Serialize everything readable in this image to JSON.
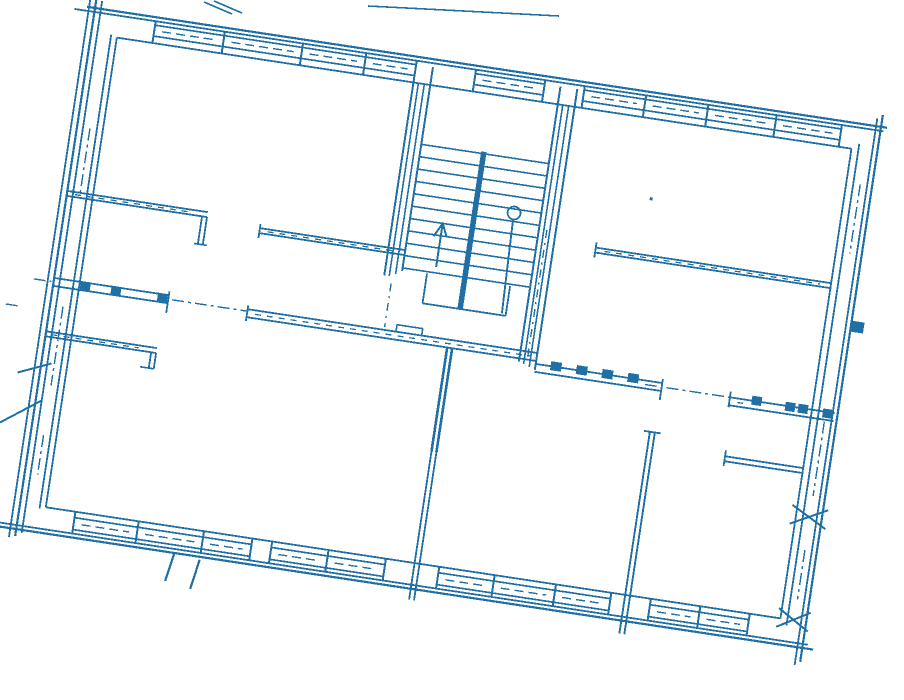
{
  "colors": {
    "ink": "#2070a6",
    "paper": "#ffffff"
  },
  "canvas": {
    "width": 904,
    "height": 700
  },
  "layout": {
    "origin_x": 95,
    "origin_y": 8,
    "rotation_deg": 8.6,
    "plan_width": 795,
    "plan_height": 527
  },
  "plan_layers": [
    {
      "name": "exterior-walls",
      "lines": [
        [
          -8,
          0,
          801,
          0,
          2.2
        ],
        [
          -20,
          4,
          798,
          4,
          1.8
        ],
        [
          26,
          26,
          769,
          26,
          1.8
        ],
        [
          26,
          501,
          769,
          501,
          1.8
        ],
        [
          -28,
          523,
          800,
          523,
          1.8
        ],
        [
          -20,
          527,
          806,
          527,
          2.2
        ],
        [
          -6,
          -10,
          -6,
          536,
          1.8
        ],
        [
          0,
          -14,
          0,
          534,
          2.2
        ],
        [
          6,
          -8,
          6,
          530,
          1.8
        ],
        [
          20,
          24,
          20,
          503,
          1.8
        ],
        [
          26,
          26,
          26,
          501,
          1.8
        ],
        [
          769,
          26,
          769,
          501,
          1.8
        ],
        [
          776,
          20,
          776,
          507,
          1.8
        ],
        [
          790,
          -8,
          790,
          545,
          1.8
        ],
        [
          795,
          -12,
          795,
          541,
          2.2
        ]
      ]
    },
    {
      "name": "ribbon-windows",
      "lines": [
        [
          62,
          8,
          326,
          8,
          1.7
        ],
        [
          62,
          19,
          326,
          19,
          1.7
        ],
        [
          386,
          8,
          456,
          8,
          1.7
        ],
        [
          386,
          19,
          456,
          19,
          1.7
        ],
        [
          496,
          8,
          756,
          8,
          1.7
        ],
        [
          496,
          19,
          756,
          19,
          1.7
        ],
        [
          62,
          4,
          62,
          26,
          2
        ],
        [
          132,
          4,
          132,
          26,
          2
        ],
        [
          211,
          4,
          211,
          26,
          2
        ],
        [
          275,
          4,
          275,
          26,
          2
        ],
        [
          326,
          4,
          326,
          26,
          2
        ],
        [
          386,
          4,
          386,
          26,
          2
        ],
        [
          456,
          4,
          456,
          26,
          2
        ],
        [
          496,
          4,
          496,
          26,
          2
        ],
        [
          558,
          4,
          558,
          26,
          2
        ],
        [
          621,
          4,
          621,
          26,
          2
        ],
        [
          690,
          4,
          690,
          26,
          2
        ],
        [
          756,
          4,
          756,
          26,
          2
        ],
        [
          56,
          507,
          235,
          507,
          1.7
        ],
        [
          56,
          519,
          235,
          519,
          1.7
        ],
        [
          255,
          507,
          370,
          507,
          1.7
        ],
        [
          255,
          519,
          370,
          519,
          1.7
        ],
        [
          424,
          507,
          598,
          507,
          1.7
        ],
        [
          424,
          519,
          598,
          519,
          1.7
        ],
        [
          638,
          507,
          738,
          507,
          1.7
        ],
        [
          638,
          519,
          738,
          519,
          1.7
        ],
        [
          56,
          501,
          56,
          523,
          2
        ],
        [
          120,
          501,
          120,
          523,
          2
        ],
        [
          186,
          501,
          186,
          523,
          2
        ],
        [
          235,
          501,
          235,
          523,
          2
        ],
        [
          255,
          501,
          255,
          523,
          2
        ],
        [
          312,
          501,
          312,
          523,
          2
        ],
        [
          370,
          501,
          370,
          523,
          2
        ],
        [
          424,
          501,
          424,
          523,
          2
        ],
        [
          480,
          501,
          480,
          523,
          2
        ],
        [
          542,
          501,
          542,
          523,
          2
        ],
        [
          598,
          501,
          598,
          523,
          2
        ],
        [
          638,
          501,
          638,
          523,
          2
        ],
        [
          688,
          501,
          688,
          523,
          2
        ],
        [
          738,
          501,
          738,
          523,
          2
        ]
      ],
      "dash": "9 5",
      "dashed": [
        [
          70,
          13.5,
          124,
          13.5,
          1.4
        ],
        [
          140,
          13.5,
          203,
          13.5,
          1.4
        ],
        [
          219,
          13.5,
          267,
          13.5,
          1.4
        ],
        [
          283,
          13.5,
          318,
          13.5,
          1.4
        ],
        [
          394,
          13.5,
          448,
          13.5,
          1.4
        ],
        [
          504,
          13.5,
          550,
          13.5,
          1.4
        ],
        [
          566,
          13.5,
          613,
          13.5,
          1.4
        ],
        [
          629,
          13.5,
          682,
          13.5,
          1.4
        ],
        [
          698,
          13.5,
          748,
          13.5,
          1.4
        ],
        [
          64,
          513,
          112,
          513,
          1.4
        ],
        [
          128,
          513,
          178,
          513,
          1.4
        ],
        [
          194,
          513,
          227,
          513,
          1.4
        ],
        [
          263,
          513,
          304,
          513,
          1.4
        ],
        [
          320,
          513,
          362,
          513,
          1.4
        ],
        [
          432,
          513,
          472,
          513,
          1.4
        ],
        [
          488,
          513,
          534,
          513,
          1.4
        ],
        [
          550,
          513,
          590,
          513,
          1.4
        ],
        [
          646,
          513,
          680,
          513,
          1.4
        ],
        [
          696,
          513,
          730,
          513,
          1.4
        ]
      ]
    },
    {
      "name": "interior-walls",
      "lines": [
        [
          0,
          185,
          142,
          185,
          1.8
        ],
        [
          0,
          190,
          142,
          190,
          1.8
        ],
        [
          137,
          190,
          137,
          218,
          1.8
        ],
        [
          142,
          190,
          142,
          218,
          1.8
        ],
        [
          133,
          218,
          146,
          218,
          1.6
        ],
        [
          196,
          193,
          344,
          193,
          1.8
        ],
        [
          196,
          198,
          344,
          198,
          1.8
        ],
        [
          196,
          189,
          196,
          203,
          1.8
        ],
        [
          531,
          162,
          770,
          162,
          1.8
        ],
        [
          531,
          167,
          770,
          167,
          1.8
        ],
        [
          531,
          157,
          531,
          172,
          1.8
        ],
        [
          0,
          327,
          112,
          327,
          1.8
        ],
        [
          0,
          332,
          112,
          332,
          1.8
        ],
        [
          107,
          332,
          107,
          348,
          1.8
        ],
        [
          112,
          332,
          112,
          348,
          1.8
        ],
        [
          98,
          348,
          112,
          348,
          1.6
        ],
        [
          0,
          273,
          116,
          273,
          1.8
        ],
        [
          0,
          281,
          116,
          281,
          1.8
        ],
        [
          116,
          269,
          116,
          291,
          1.8
        ],
        [
          196,
          275,
          489,
          275,
          1.8
        ],
        [
          196,
          283,
          489,
          283,
          1.8
        ],
        [
          196,
          271,
          196,
          287,
          1.8
        ],
        [
          346,
          268,
          372,
          268,
          1.6
        ],
        [
          346,
          268,
          346,
          275,
          1.6
        ],
        [
          372,
          268,
          372,
          275,
          1.6
        ],
        [
          489,
          286,
          617,
          286,
          1.8
        ],
        [
          489,
          294,
          617,
          294,
          1.8
        ],
        [
          617,
          282,
          617,
          303,
          1.8
        ],
        [
          686,
          290,
          792,
          290,
          1.8
        ],
        [
          686,
          298,
          792,
          298,
          1.8
        ],
        [
          686,
          284,
          686,
          300,
          1.8
        ],
        [
          399,
          283,
          399,
          388,
          2.6
        ],
        [
          404,
          283,
          404,
          388,
          2.6
        ],
        [
          399,
          388,
          399,
          538,
          1.8
        ],
        [
          404,
          388,
          404,
          538,
          1.8
        ],
        [
          612,
          336,
          612,
          540,
          1.9
        ],
        [
          617,
          336,
          617,
          540,
          1.9
        ],
        [
          606,
          336,
          623,
          336,
          1.8
        ],
        [
          690,
          349,
          770,
          349,
          1.8
        ],
        [
          690,
          354,
          770,
          354,
          1.8
        ],
        [
          690,
          343,
          690,
          359,
          1.8
        ],
        [
          160,
          527,
          155,
          556,
          2.2
        ],
        [
          186,
          530,
          181,
          560,
          2.2
        ]
      ],
      "dash": "6 6",
      "dashed": [
        [
          8,
          187.5,
          128,
          187.5,
          1.3
        ],
        [
          204,
          195.5,
          336,
          195.5,
          1.3
        ],
        [
          540,
          164.5,
          758,
          164.5,
          1.3
        ],
        [
          6,
          329.5,
          94,
          329.5,
          1.3
        ],
        [
          204,
          279,
          482,
          279,
          1.3
        ],
        [
          694,
          294,
          706,
          294,
          1.3
        ]
      ]
    },
    {
      "name": "staircase",
      "lines": [
        [
          326,
          8,
          326,
          221,
          2
        ],
        [
          331,
          26,
          331,
          221,
          1.6
        ],
        [
          337,
          26,
          337,
          218,
          1.6
        ],
        [
          343,
          8,
          343,
          214,
          2
        ],
        [
          472,
          8,
          472,
          286,
          2
        ],
        [
          477,
          26,
          477,
          288,
          1.6
        ],
        [
          483,
          26,
          483,
          290,
          1.6
        ],
        [
          489,
          8,
          489,
          292,
          2
        ],
        [
          343,
          86,
          472,
          86,
          1.6
        ],
        [
          343,
          98.5,
          472,
          98.5,
          1.6
        ],
        [
          343,
          111,
          472,
          111,
          1.6
        ],
        [
          343,
          123.5,
          472,
          123.5,
          1.6
        ],
        [
          343,
          136,
          472,
          136,
          1.6
        ],
        [
          343,
          148.5,
          472,
          148.5,
          1.6
        ],
        [
          343,
          161,
          472,
          161,
          1.6
        ],
        [
          343,
          173.5,
          472,
          173.5,
          1.6
        ],
        [
          343,
          186,
          472,
          186,
          1.6
        ],
        [
          343,
          198.5,
          472,
          198.5,
          1.6
        ],
        [
          343,
          211,
          472,
          211,
          1.6
        ],
        [
          406,
          84,
          406,
          243,
          5.5
        ],
        [
          368,
          213,
          368,
          243,
          1.8
        ],
        [
          452,
          213,
          452,
          243,
          1.8
        ],
        [
          368,
          243,
          452,
          243,
          1.8
        ],
        [
          445,
          147,
          448,
          241,
          1.9
        ],
        [
          376,
          205,
          376,
          163,
          2
        ]
      ],
      "dash": "8 5 2 5",
      "dashed": [
        [
          334,
          228,
          334,
          272,
          1.4
        ],
        [
          480,
          152,
          480,
          280,
          1.4
        ]
      ],
      "circles": [
        [
          445,
          140,
          6.5,
          1.8
        ]
      ],
      "polylines": [
        {
          "pts": [
            [
              369,
              175
            ],
            [
              376,
              161
            ],
            [
              382,
              174
            ]
          ],
          "w": 2
        }
      ]
    },
    {
      "name": "axis-lines",
      "dash": "12 4 3 4",
      "dashed": [
        [
          -20,
          277,
          -2,
          277,
          1.4
        ],
        [
          120,
          277,
          196,
          277,
          1.4
        ],
        [
          600,
          290,
          612,
          290,
          1.4
        ],
        [
          622,
          290,
          686,
          290,
          1.4
        ],
        [
          13,
          120,
          13,
          185,
          1.4
        ],
        [
          13,
          300,
          13,
          380,
          1.4
        ],
        [
          13,
          430,
          13,
          470,
          1.4
        ],
        [
          783,
          60,
          783,
          130,
          1.4
        ],
        [
          783,
          300,
          783,
          375,
          1.4
        ],
        [
          783,
          430,
          783,
          480,
          1.4
        ],
        [
          -44,
          306,
          -32,
          306,
          1.4
        ]
      ]
    },
    {
      "name": "wall-marks",
      "rects": [
        [
          27,
          272,
          10,
          9
        ],
        [
          58,
          272,
          10,
          9
        ],
        [
          105,
          272,
          10,
          9
        ],
        [
          504,
          281,
          11,
          9
        ],
        [
          530,
          281,
          11,
          9
        ],
        [
          556,
          281,
          11,
          9
        ],
        [
          582,
          281,
          11,
          9
        ],
        [
          708,
          285,
          10,
          9
        ],
        [
          742,
          286,
          10,
          9
        ],
        [
          755,
          286,
          10,
          9
        ],
        [
          780,
          287,
          10,
          9
        ],
        [
          795,
          196,
          13,
          11
        ],
        [
          577,
          104,
          3,
          3
        ]
      ],
      "lines": [
        [
          764,
          406,
          800,
          387,
          2
        ],
        [
          764,
          387,
          800,
          406,
          2
        ],
        [
          766,
          510,
          798,
          491,
          2
        ],
        [
          766,
          491,
          798,
          510,
          2
        ],
        [
          -32,
          424,
          6,
          396,
          2
        ],
        [
          -22,
          372,
          10,
          358,
          2
        ]
      ]
    }
  ],
  "screen_marks": {
    "name": "scan-artifacts",
    "lines": [
      [
        204,
        2,
        232,
        14,
        1.6
      ],
      [
        214,
        1,
        242,
        13,
        1.6
      ],
      [
        368,
        6,
        559,
        16,
        1.6
      ]
    ]
  }
}
